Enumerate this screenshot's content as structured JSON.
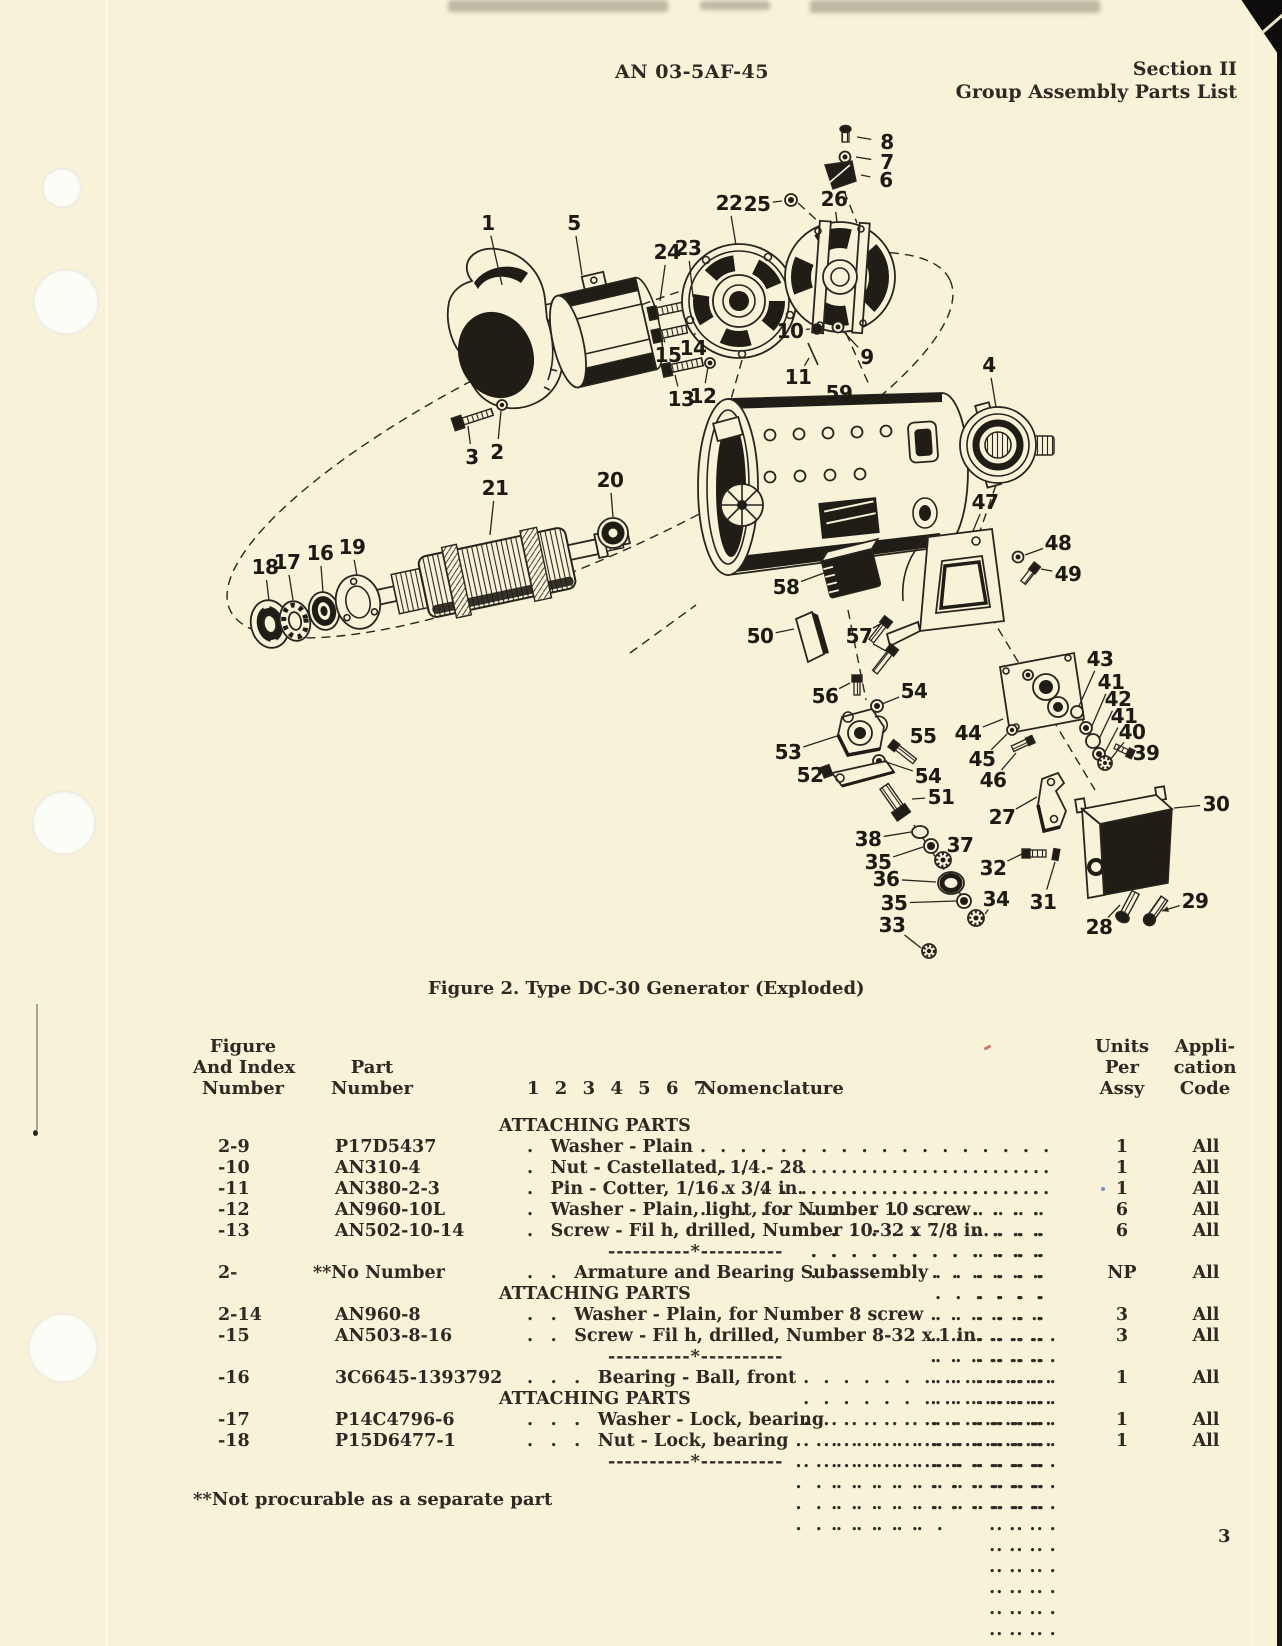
{
  "page": {
    "header_center": "AN 03-5AF-45",
    "header_right_line1": "Section II",
    "header_right_line2": "Group Assembly Parts List",
    "page_number": "3",
    "footnote": "**Not procurable as a separate part"
  },
  "figure": {
    "caption": "Figure 2.  Type DC-30 Generator (Exploded)",
    "callouts": [
      {
        "t": "1",
        "x": 358,
        "y": 118,
        "tx": 372,
        "ty": 180
      },
      {
        "t": "5",
        "x": 444,
        "y": 118,
        "tx": 452,
        "ty": 170
      },
      {
        "t": "8",
        "x": 757,
        "y": 37,
        "tx": 727,
        "ty": 32
      },
      {
        "t": "7",
        "x": 757,
        "y": 57,
        "tx": 726,
        "ty": 52
      },
      {
        "t": "6",
        "x": 756,
        "y": 75,
        "tx": 731,
        "ty": 70
      },
      {
        "t": "22",
        "x": 599,
        "y": 98,
        "tx": 606,
        "ty": 140
      },
      {
        "t": "25",
        "x": 627,
        "y": 99,
        "tx": 652,
        "ty": 96
      },
      {
        "t": "26",
        "x": 704,
        "y": 94,
        "tx": 707,
        "ty": 117
      },
      {
        "t": "24",
        "x": 537,
        "y": 147,
        "tx": 530,
        "ty": 196
      },
      {
        "t": "23",
        "x": 558,
        "y": 143,
        "tx": 563,
        "ty": 192
      },
      {
        "t": "15",
        "x": 538,
        "y": 250,
        "tx": 534,
        "ty": 234
      },
      {
        "t": "14",
        "x": 563,
        "y": 243,
        "tx": 565,
        "ty": 228
      },
      {
        "t": "13",
        "x": 551,
        "y": 294,
        "tx": 545,
        "ty": 270
      },
      {
        "t": "12",
        "x": 573,
        "y": 291,
        "tx": 578,
        "ty": 262
      },
      {
        "t": "10",
        "x": 660,
        "y": 226,
        "tx": 680,
        "ty": 224
      },
      {
        "t": "9",
        "x": 737,
        "y": 252,
        "tx": 714,
        "ty": 227
      },
      {
        "t": "11",
        "x": 668,
        "y": 272,
        "tx": 679,
        "ty": 253
      },
      {
        "t": "59",
        "x": 709,
        "y": 288,
        "tx": 698,
        "ty": 300
      },
      {
        "t": "4",
        "x": 859,
        "y": 260,
        "tx": 866,
        "ty": 302
      },
      {
        "t": "3",
        "x": 342,
        "y": 352,
        "tx": 338,
        "ty": 321
      },
      {
        "t": "2",
        "x": 367,
        "y": 347,
        "tx": 371,
        "ty": 306
      },
      {
        "t": "21",
        "x": 365,
        "y": 383,
        "tx": 360,
        "ty": 430
      },
      {
        "t": "20",
        "x": 480,
        "y": 375,
        "tx": 483,
        "ty": 412
      },
      {
        "t": "18",
        "x": 135,
        "y": 462,
        "tx": 139,
        "ty": 496
      },
      {
        "t": "17",
        "x": 157,
        "y": 457,
        "tx": 163,
        "ty": 495
      },
      {
        "t": "16",
        "x": 190,
        "y": 448,
        "tx": 193,
        "ty": 487
      },
      {
        "t": "19",
        "x": 222,
        "y": 442,
        "tx": 227,
        "ty": 471
      },
      {
        "t": "47",
        "x": 855,
        "y": 397,
        "tx": 843,
        "ty": 426
      },
      {
        "t": "48",
        "x": 928,
        "y": 438,
        "tx": 895,
        "ty": 450
      },
      {
        "t": "49",
        "x": 938,
        "y": 469,
        "tx": 911,
        "ty": 464
      },
      {
        "t": "58",
        "x": 656,
        "y": 482,
        "tx": 694,
        "ty": 468
      },
      {
        "t": "50",
        "x": 630,
        "y": 531,
        "tx": 664,
        "ty": 524
      },
      {
        "t": "57",
        "x": 729,
        "y": 531,
        "tx": 752,
        "ty": 518,
        "tx2": 756,
        "ty2": 546
      },
      {
        "t": "56",
        "x": 695,
        "y": 591,
        "tx": 720,
        "ty": 578
      },
      {
        "t": "54",
        "x": 784,
        "y": 586,
        "tx": 752,
        "ty": 599
      },
      {
        "t": "53",
        "x": 658,
        "y": 647,
        "tx": 710,
        "ty": 630
      },
      {
        "t": "55",
        "x": 793,
        "y": 631,
        "tx": 777,
        "ty": 637
      },
      {
        "t": "54",
        "x": 798,
        "y": 671,
        "tx": 756,
        "ty": 657
      },
      {
        "t": "52",
        "x": 680,
        "y": 670,
        "tx": 700,
        "ty": 671
      },
      {
        "t": "51",
        "x": 811,
        "y": 692,
        "tx": 782,
        "ty": 694
      },
      {
        "t": "38",
        "x": 738,
        "y": 734,
        "tx": 781,
        "ty": 727
      },
      {
        "t": "35",
        "x": 748,
        "y": 757,
        "tx": 793,
        "ty": 742
      },
      {
        "t": "37",
        "x": 830,
        "y": 740,
        "tx": 822,
        "ty": 752
      },
      {
        "t": "36",
        "x": 756,
        "y": 774,
        "tx": 806,
        "ty": 777
      },
      {
        "t": "35",
        "x": 764,
        "y": 798,
        "tx": 826,
        "ty": 796
      },
      {
        "t": "34",
        "x": 866,
        "y": 794,
        "tx": 855,
        "ty": 809
      },
      {
        "t": "33",
        "x": 762,
        "y": 820,
        "tx": 791,
        "ty": 843
      },
      {
        "t": "44",
        "x": 838,
        "y": 628,
        "tx": 873,
        "ty": 614
      },
      {
        "t": "45",
        "x": 852,
        "y": 654,
        "tx": 877,
        "ty": 629
      },
      {
        "t": "46",
        "x": 863,
        "y": 675,
        "tx": 886,
        "ty": 648
      },
      {
        "t": "43",
        "x": 970,
        "y": 554,
        "tx": 949,
        "ty": 601
      },
      {
        "t": "41",
        "x": 981,
        "y": 577,
        "tx": 962,
        "ty": 621
      },
      {
        "t": "42",
        "x": 988,
        "y": 594,
        "tx": 969,
        "ty": 634
      },
      {
        "t": "41",
        "x": 994,
        "y": 611,
        "tx": 975,
        "ty": 647
      },
      {
        "t": "40",
        "x": 1002,
        "y": 627,
        "tx": 980,
        "ty": 655
      },
      {
        "t": "39",
        "x": 1016,
        "y": 648,
        "tx": 997,
        "ty": 646
      },
      {
        "t": "27",
        "x": 872,
        "y": 712,
        "tx": 907,
        "ty": 692
      },
      {
        "t": "30",
        "x": 1086,
        "y": 699,
        "tx": 1044,
        "ty": 703
      },
      {
        "t": "32",
        "x": 863,
        "y": 763,
        "tx": 892,
        "ty": 749
      },
      {
        "t": "31",
        "x": 913,
        "y": 797,
        "tx": 925,
        "ty": 757
      },
      {
        "t": "28",
        "x": 969,
        "y": 822,
        "tx": 990,
        "ty": 800
      },
      {
        "t": "29",
        "x": 1065,
        "y": 796,
        "tx": 1032,
        "ty": 806,
        "arrow": true
      }
    ]
  },
  "table": {
    "headers": {
      "fig1": "Figure",
      "fig2": "And Index",
      "fig3": "Number",
      "part1": "Part",
      "part2": "Number",
      "nom_nums": "1 2 3 4 5 6 7",
      "nom": "Nomenclature",
      "units1": "Units",
      "units2": "Per",
      "units3": "Assy",
      "code1": "Appli-",
      "code2": "cation",
      "code3": "Code"
    },
    "rows": [
      {
        "type": "section",
        "label": "ATTACHING PARTS"
      },
      {
        "type": "item",
        "index": "2-9",
        "part": "P17D5437",
        "level": 1,
        "nomen": "Washer - Plain",
        "units": "1",
        "code": "All",
        "leader": true
      },
      {
        "type": "item",
        "index": "-10",
        "part": "AN310-4",
        "level": 1,
        "nomen": "Nut - Castellated, 1/4 - 28",
        "units": "1",
        "code": "All",
        "leader": true
      },
      {
        "type": "item",
        "index": "-11",
        "part": "AN380-2-3",
        "level": 1,
        "nomen": "Pin - Cotter, 1/16 x 3/4 in.",
        "units": "1",
        "code": "All",
        "leader": true
      },
      {
        "type": "item",
        "index": "-12",
        "part": "AN960-10L",
        "level": 1,
        "nomen": "Washer - Plain, light, for Number 10 screw",
        "units": "6",
        "code": "All",
        "leader": true
      },
      {
        "type": "item",
        "index": "-13",
        "part": "AN502-10-14",
        "level": 1,
        "nomen": "Screw - Fil h, drilled, Number 10-32 x 7/8 in.",
        "units": "6",
        "code": "All",
        "leader": true
      },
      {
        "type": "separator",
        "label": "----------*----------"
      },
      {
        "type": "item",
        "index": "2-",
        "part": "**No Number",
        "level": 2,
        "nomen": "Armature and Bearing Subassembly",
        "units": "NP",
        "code": "All",
        "leader": true
      },
      {
        "type": "section",
        "label": "ATTACHING PARTS"
      },
      {
        "type": "item",
        "index": "2-14",
        "part": "AN960-8",
        "level": 2,
        "nomen": "Washer - Plain, for Number 8 screw",
        "units": "3",
        "code": "All",
        "leader": true
      },
      {
        "type": "item",
        "index": "-15",
        "part": "AN503-8-16",
        "level": 2,
        "nomen": "Screw - Fil h, drilled, Number 8-32 x 1 in.",
        "units": "3",
        "code": "All",
        "leader": true
      },
      {
        "type": "separator",
        "label": "----------*----------"
      },
      {
        "type": "item",
        "index": "-16",
        "part": "3C6645-1393792",
        "level": 3,
        "nomen": "Bearing - Ball, front",
        "units": "1",
        "code": "All",
        "leader": true
      },
      {
        "type": "section",
        "label": "ATTACHING PARTS"
      },
      {
        "type": "item",
        "index": "-17",
        "part": "P14C4796-6",
        "level": 3,
        "nomen": "Washer - Lock, bearing",
        "units": "1",
        "code": "All",
        "leader": true
      },
      {
        "type": "item",
        "index": "-18",
        "part": "P15D6477-1",
        "level": 3,
        "nomen": "Nut - Lock, bearing",
        "units": "1",
        "code": "All",
        "leader": true
      },
      {
        "type": "separator",
        "label": "----------*----------"
      }
    ]
  }
}
